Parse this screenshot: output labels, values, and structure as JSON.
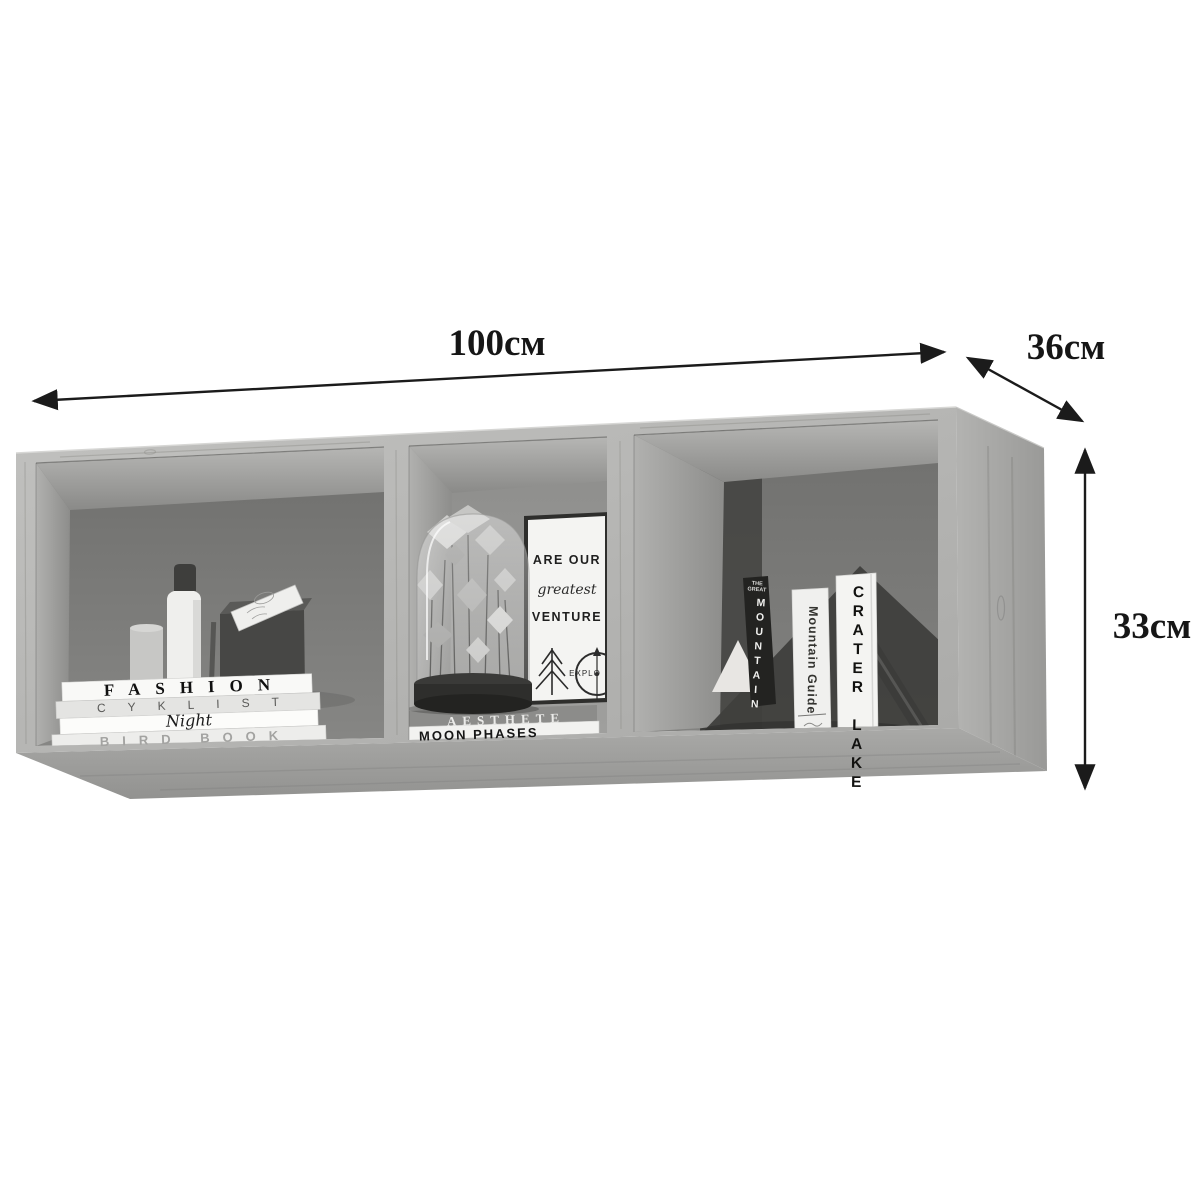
{
  "page": {
    "background": "#ffffff"
  },
  "dimensions": {
    "width_label": "100см",
    "depth_label": "36см",
    "height_label": "33см"
  },
  "left_compartment": {
    "book_titles": [
      "FASHION",
      "CYKLIST",
      "Night",
      "BIRD BOOK"
    ]
  },
  "middle_compartment": {
    "poster_line1": "ARE OUR",
    "poster_line2": "greatest",
    "poster_line3": "VENTURE",
    "poster_badge": "EXPLO",
    "book_titles": [
      "AESTHETE",
      "MOON PHASES"
    ]
  },
  "right_compartment": {
    "book1_series": "THE GREAT",
    "book1_title": "MOUNTAIN",
    "book2_title": "Mountain Guide",
    "book3_title": "CRATER LAKE"
  }
}
